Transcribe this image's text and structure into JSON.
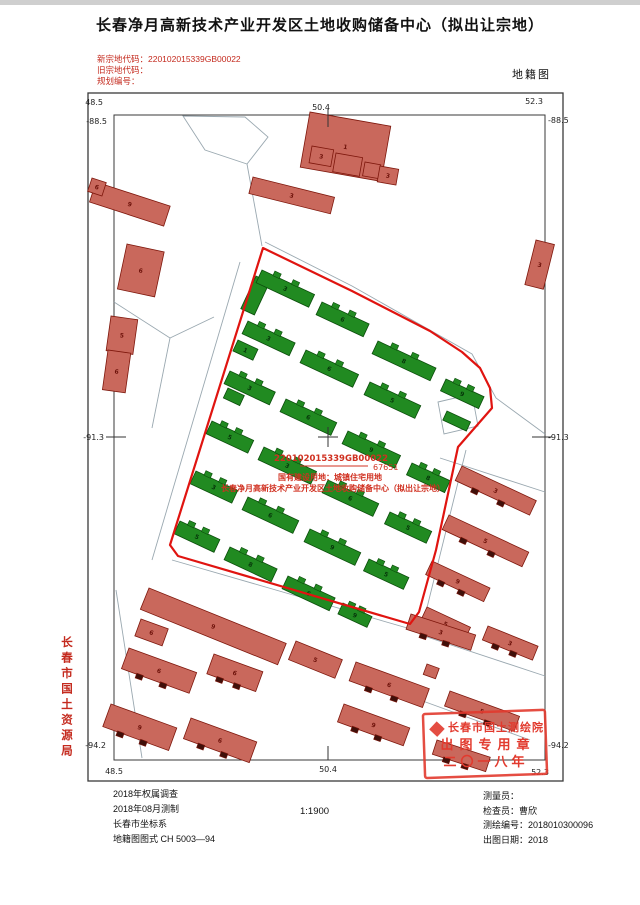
{
  "header": {
    "title": "长春净月高新技术产业开发区土地收购储备中心（拟出让宗地）",
    "codes": [
      "新宗地代码：220102015339GB00022",
      "旧宗地代码：",
      "规划编号："
    ],
    "map_type": "地籍图"
  },
  "side": {
    "bureau": "长春市国土资源局"
  },
  "annotation": {
    "parcel_code": "220102015339GB00022",
    "area": "67651",
    "land_use": "国有建设用地：城镇住宅用地",
    "owner": "长春净月高新技术产业开发区土地收购储备中心（拟出让宗地）"
  },
  "stamp": {
    "org": "长春市国土测绘院",
    "purpose": "出图专用章",
    "year": "二〇一八年"
  },
  "footer": {
    "left": [
      "2018年权属调查",
      "2018年08月测制",
      "长春市坐标系",
      "地籍图图式 CH 5003—94"
    ],
    "scale": "1:1900",
    "right": [
      "测量员：",
      "检查员：曹欣",
      "测绘编号：2018010300096",
      "出图日期：2018"
    ]
  },
  "map": {
    "colors": {
      "frame": "#3a3a3a",
      "street": "#9aa8b0",
      "boundary": "#e01410",
      "green_fill": "#218a21",
      "green_stroke": "#0b4d0b",
      "green_label": "#06360a",
      "red_fill": "#c9685c",
      "red_stroke": "#7e170c",
      "red_label": "#6e120a",
      "red_bump": "#40100a",
      "annotation": "#d03020",
      "stamp": "#e23a2e",
      "tick": "#333333"
    },
    "frame": {
      "outer": [
        88,
        93,
        475,
        688
      ],
      "inner": [
        114,
        115,
        431,
        645
      ]
    },
    "coord_labels": [
      {
        "t": "48.5",
        "x": 103,
        "y": 105,
        "a": "end"
      },
      {
        "t": "50.4",
        "x": 321,
        "y": 110,
        "a": "middle"
      },
      {
        "t": "52.3",
        "x": 534,
        "y": 104,
        "a": "middle"
      },
      {
        "t": "-88.5",
        "x": 107,
        "y": 124,
        "a": "end"
      },
      {
        "t": "-88.5",
        "x": 548,
        "y": 123,
        "a": "start"
      },
      {
        "t": "-91.3",
        "x": 104,
        "y": 440,
        "a": "end"
      },
      {
        "t": "-91.3",
        "x": 548,
        "y": 440,
        "a": "start"
      },
      {
        "t": "-94.2",
        "x": 106,
        "y": 748,
        "a": "end"
      },
      {
        "t": "-94.2",
        "x": 548,
        "y": 748,
        "a": "start"
      },
      {
        "t": "48.5",
        "x": 114,
        "y": 774,
        "a": "middle"
      },
      {
        "t": "50.4",
        "x": 328,
        "y": 772,
        "a": "middle"
      },
      {
        "t": "52.3",
        "x": 540,
        "y": 775,
        "a": "middle"
      }
    ],
    "ticks": [
      [
        328,
        109,
        328,
        127
      ],
      [
        328,
        746,
        328,
        760
      ],
      [
        106,
        437,
        126,
        437
      ],
      [
        532,
        437,
        552,
        437
      ]
    ],
    "crosshair": {
      "x": 328,
      "y": 437,
      "arm": 10
    },
    "streets": [
      "M183,116 L245,117 L268,137 L247,164 L205,150 Z",
      "M247,164 L262,246",
      "M265,242 L352,286 L472,354 L496,398 L545,434",
      "M240,262 L152,560",
      "M172,560 L300,597 L421,632 L466,450",
      "M114,302 L170,338 L214,317",
      "M170,338 L152,428",
      "M116,590 L142,758",
      "M440,458 L545,492",
      "M424,636 L545,676",
      "M420,700 L530,740"
    ],
    "boundary_points": "263,248 352,291 430,331 462,352 480,368 490,388 492,408 458,447 436,550 419,612 410,624 178,556 170,545",
    "enclave_points": "438,402 472,394 478,426 444,434",
    "green_buildings": [
      {
        "x": 256,
        "y": 276,
        "w": 15,
        "h": 36,
        "r": 25,
        "label": ""
      },
      {
        "x": 262,
        "y": 270,
        "w": 58,
        "h": 14,
        "r": 25,
        "label": "3"
      },
      {
        "x": 322,
        "y": 302,
        "w": 52,
        "h": 14,
        "r": 25,
        "label": "6"
      },
      {
        "x": 378,
        "y": 341,
        "w": 64,
        "h": 14,
        "r": 25,
        "label": "8"
      },
      {
        "x": 446,
        "y": 379,
        "w": 42,
        "h": 13,
        "r": 25,
        "label": "9"
      },
      {
        "x": 248,
        "y": 321,
        "w": 52,
        "h": 14,
        "r": 25,
        "label": "3"
      },
      {
        "x": 238,
        "y": 340,
        "w": 22,
        "h": 12,
        "r": 25,
        "label": "1"
      },
      {
        "x": 306,
        "y": 350,
        "w": 58,
        "h": 14,
        "r": 25,
        "label": "6"
      },
      {
        "x": 370,
        "y": 382,
        "w": 56,
        "h": 14,
        "r": 25,
        "label": "5"
      },
      {
        "x": 230,
        "y": 371,
        "w": 50,
        "h": 14,
        "r": 25,
        "label": "3"
      },
      {
        "x": 228,
        "y": 388,
        "w": 18,
        "h": 11,
        "r": 25,
        "label": ""
      },
      {
        "x": 286,
        "y": 399,
        "w": 56,
        "h": 14,
        "r": 25,
        "label": "6"
      },
      {
        "x": 348,
        "y": 431,
        "w": 58,
        "h": 14,
        "r": 25,
        "label": "9"
      },
      {
        "x": 412,
        "y": 463,
        "w": 42,
        "h": 13,
        "r": 25,
        "label": "8"
      },
      {
        "x": 212,
        "y": 421,
        "w": 46,
        "h": 14,
        "r": 25,
        "label": "5"
      },
      {
        "x": 264,
        "y": 447,
        "w": 58,
        "h": 14,
        "r": 25,
        "label": "3"
      },
      {
        "x": 328,
        "y": 480,
        "w": 56,
        "h": 14,
        "r": 25,
        "label": "6"
      },
      {
        "x": 390,
        "y": 512,
        "w": 46,
        "h": 13,
        "r": 25,
        "label": "5"
      },
      {
        "x": 196,
        "y": 471,
        "w": 46,
        "h": 14,
        "r": 25,
        "label": "3"
      },
      {
        "x": 248,
        "y": 497,
        "w": 56,
        "h": 14,
        "r": 25,
        "label": "6"
      },
      {
        "x": 310,
        "y": 529,
        "w": 56,
        "h": 14,
        "r": 25,
        "label": "9"
      },
      {
        "x": 369,
        "y": 559,
        "w": 44,
        "h": 13,
        "r": 25,
        "label": "5"
      },
      {
        "x": 180,
        "y": 521,
        "w": 44,
        "h": 14,
        "r": 25,
        "label": "5"
      },
      {
        "x": 230,
        "y": 547,
        "w": 52,
        "h": 14,
        "r": 25,
        "label": "8"
      },
      {
        "x": 288,
        "y": 576,
        "w": 52,
        "h": 14,
        "r": 25,
        "label": "6"
      },
      {
        "x": 343,
        "y": 603,
        "w": 32,
        "h": 12,
        "r": 25,
        "label": "9"
      },
      {
        "x": 447,
        "y": 411,
        "w": 26,
        "h": 10,
        "r": 25,
        "label": ""
      }
    ],
    "red_buildings": [
      {
        "x": 310,
        "y": 112,
        "w": 82,
        "h": 56,
        "r": 10,
        "label": "1"
      },
      {
        "x": 312,
        "y": 146,
        "w": 22,
        "h": 17,
        "r": 10,
        "label": "3"
      },
      {
        "x": 336,
        "y": 153,
        "w": 27,
        "h": 19,
        "r": 10,
        "label": ""
      },
      {
        "x": 365,
        "y": 162,
        "w": 16,
        "h": 14,
        "r": 10,
        "label": ""
      },
      {
        "x": 380,
        "y": 166,
        "w": 19,
        "h": 16,
        "r": 10,
        "label": "3"
      },
      {
        "x": 253,
        "y": 177,
        "w": 84,
        "h": 17,
        "r": 14,
        "label": "3"
      },
      {
        "x": 536,
        "y": 240,
        "w": 19,
        "h": 46,
        "r": 14,
        "label": "3"
      },
      {
        "x": 96,
        "y": 182,
        "w": 78,
        "h": 21,
        "r": 18,
        "label": "9"
      },
      {
        "x": 92,
        "y": 178,
        "w": 15,
        "h": 14,
        "r": 18,
        "label": "6"
      },
      {
        "x": 127,
        "y": 244,
        "w": 38,
        "h": 46,
        "r": 12,
        "label": "6"
      },
      {
        "x": 111,
        "y": 316,
        "w": 27,
        "h": 35,
        "r": 8,
        "label": "5"
      },
      {
        "x": 108,
        "y": 350,
        "w": 23,
        "h": 40,
        "r": 8,
        "label": "6"
      },
      {
        "x": 462,
        "y": 466,
        "w": 82,
        "h": 16,
        "r": 25,
        "label": "3",
        "bumps": true
      },
      {
        "x": 449,
        "y": 515,
        "w": 88,
        "h": 16,
        "r": 25,
        "label": "5",
        "bumps": true
      },
      {
        "x": 432,
        "y": 561,
        "w": 64,
        "h": 15,
        "r": 25,
        "label": "9",
        "bumps": true
      },
      {
        "x": 427,
        "y": 607,
        "w": 48,
        "h": 15,
        "r": 25,
        "label": "5",
        "bumps": true
      },
      {
        "x": 488,
        "y": 626,
        "w": 54,
        "h": 15,
        "r": 22,
        "label": "3",
        "bumps": true
      },
      {
        "x": 149,
        "y": 588,
        "w": 148,
        "h": 23,
        "r": 22,
        "label": "9"
      },
      {
        "x": 141,
        "y": 619,
        "w": 29,
        "h": 18,
        "r": 20,
        "label": "6"
      },
      {
        "x": 129,
        "y": 648,
        "w": 72,
        "h": 22,
        "r": 20,
        "label": "6",
        "bumps": true
      },
      {
        "x": 214,
        "y": 654,
        "w": 52,
        "h": 21,
        "r": 20,
        "label": "6",
        "bumps": true
      },
      {
        "x": 111,
        "y": 704,
        "w": 70,
        "h": 24,
        "r": 20,
        "label": "9",
        "bumps": true
      },
      {
        "x": 191,
        "y": 718,
        "w": 70,
        "h": 22,
        "r": 20,
        "label": "6",
        "bumps": true
      },
      {
        "x": 296,
        "y": 641,
        "w": 50,
        "h": 20,
        "r": 22,
        "label": "5"
      },
      {
        "x": 411,
        "y": 614,
        "w": 68,
        "h": 16,
        "r": 18,
        "label": "3",
        "bumps": true
      },
      {
        "x": 356,
        "y": 662,
        "w": 78,
        "h": 20,
        "r": 20,
        "label": "6",
        "bumps": true
      },
      {
        "x": 344,
        "y": 704,
        "w": 70,
        "h": 19,
        "r": 20,
        "label": "9",
        "bumps": true
      },
      {
        "x": 450,
        "y": 691,
        "w": 74,
        "h": 16,
        "r": 20,
        "label": "5",
        "bumps": true
      },
      {
        "x": 427,
        "y": 664,
        "w": 13,
        "h": 11,
        "r": 20,
        "label": ""
      },
      {
        "x": 437,
        "y": 740,
        "w": 56,
        "h": 15,
        "r": 18,
        "label": "",
        "bumps": true
      }
    ]
  }
}
